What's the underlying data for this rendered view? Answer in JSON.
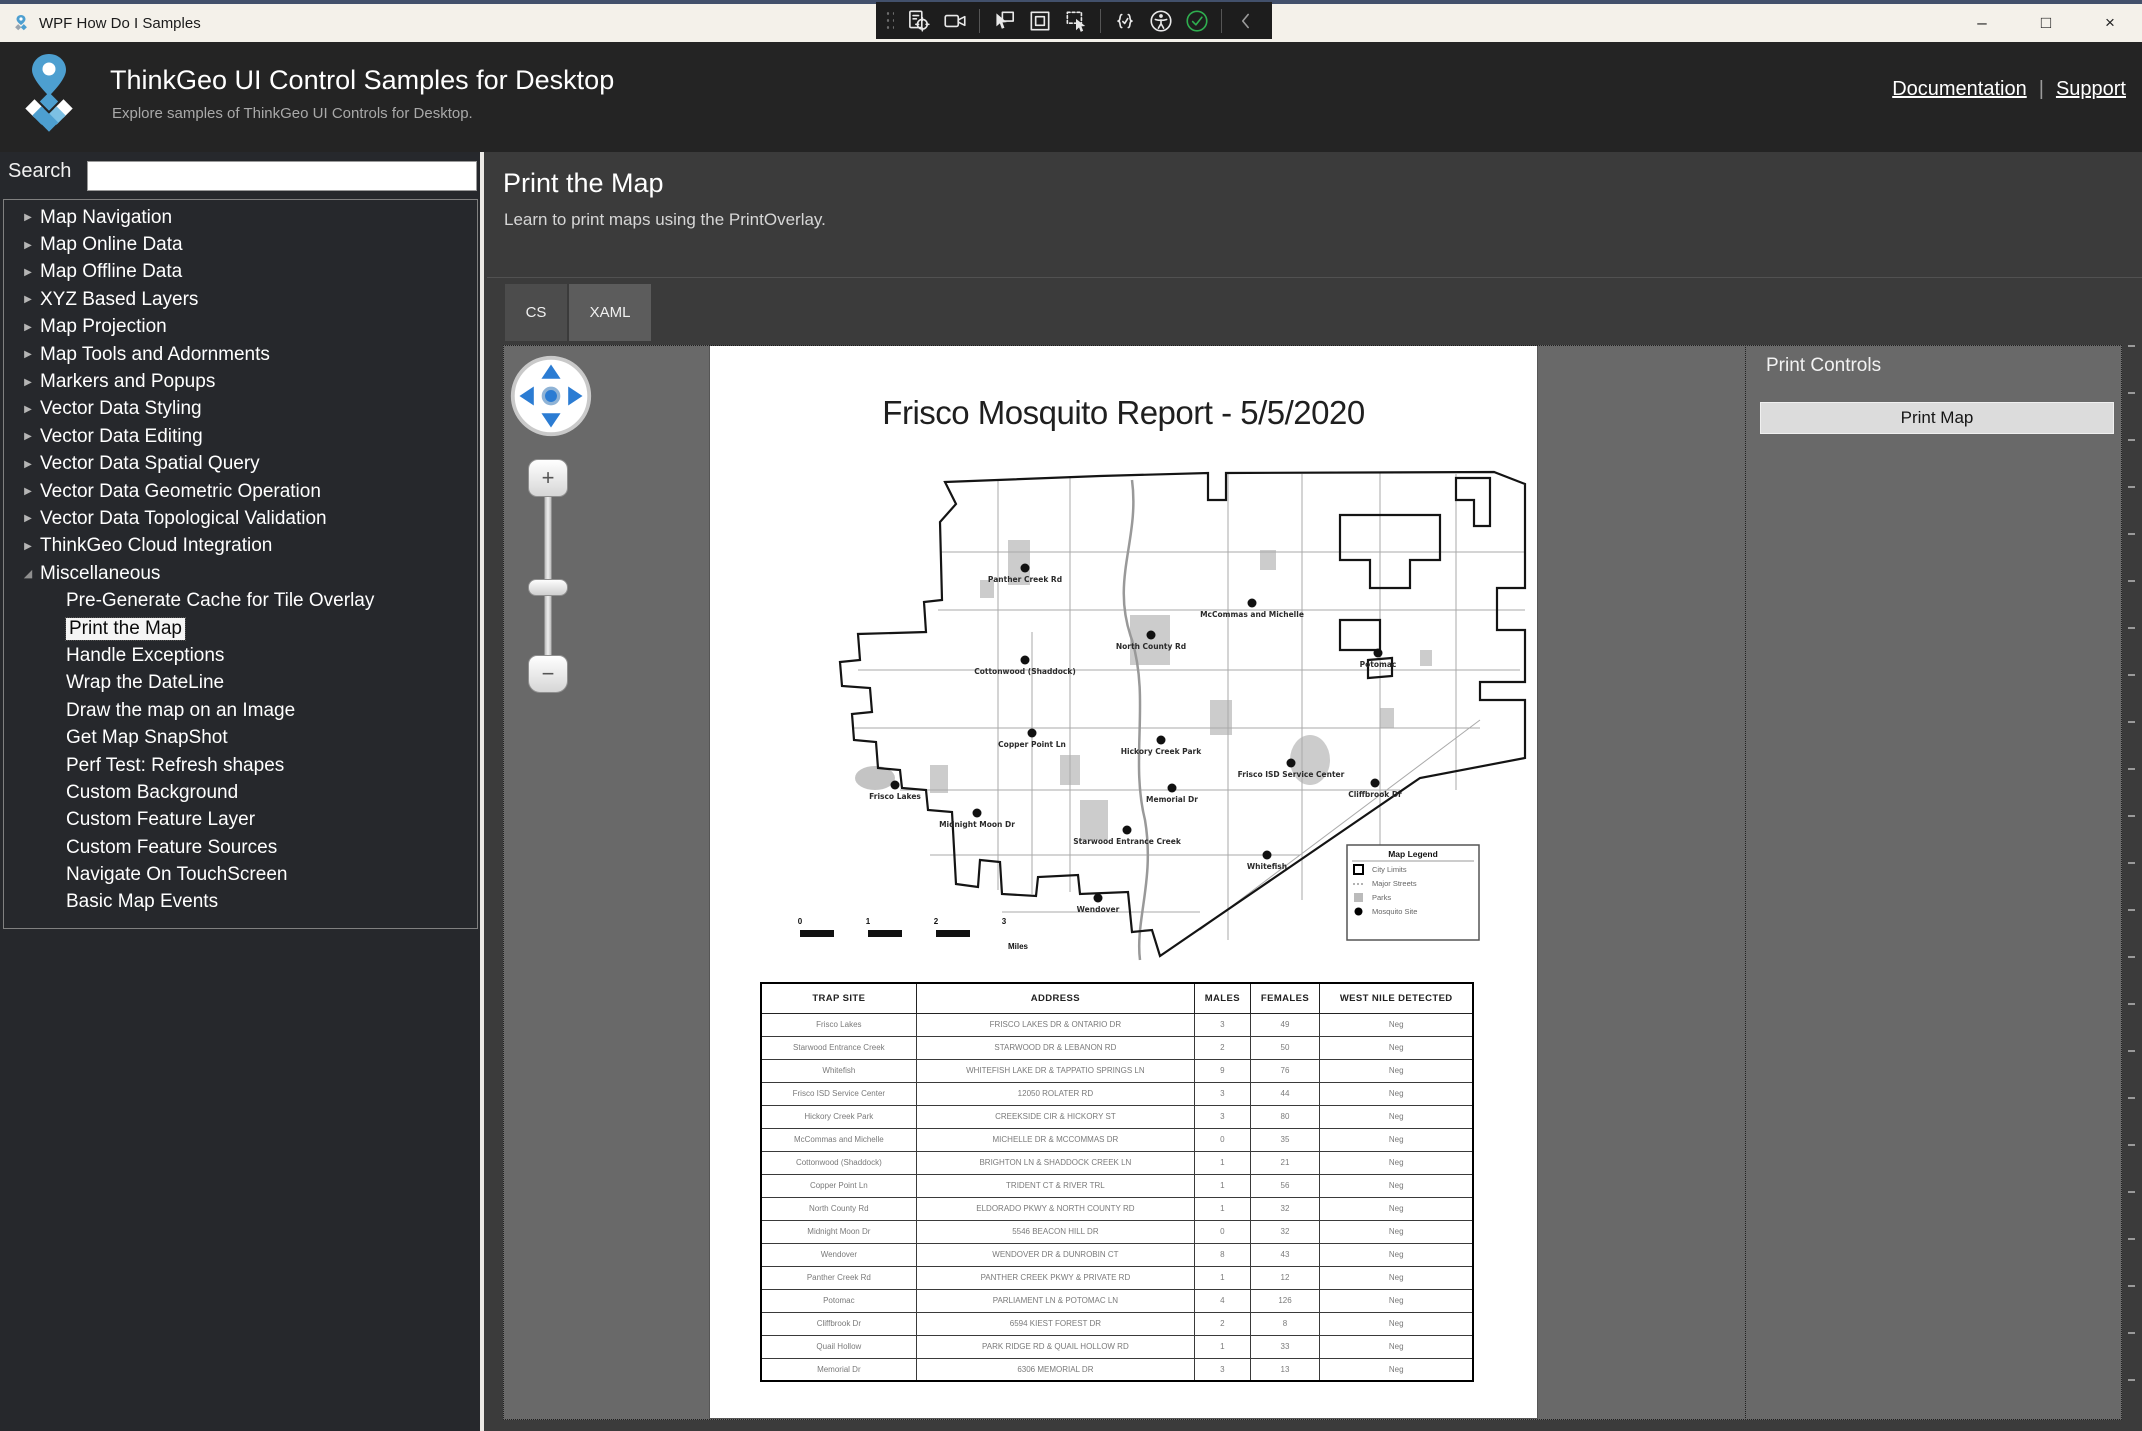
{
  "window": {
    "title": "WPF How Do I Samples",
    "controls": [
      {
        "name": "minimize-button",
        "glyph": "–"
      },
      {
        "name": "maximize-button",
        "glyph": "□"
      },
      {
        "name": "close-button",
        "glyph": "×"
      }
    ]
  },
  "overlay_toolbar": {
    "icons": [
      {
        "name": "record-target-icon"
      },
      {
        "name": "camera-icon"
      },
      {
        "name": "cursor-select-icon"
      },
      {
        "name": "window-frame-icon"
      },
      {
        "name": "region-capture-icon"
      },
      {
        "name": "code-check-icon"
      },
      {
        "name": "accessibility-icon"
      },
      {
        "name": "check-circle-icon"
      },
      {
        "name": "chevron-left-icon"
      }
    ]
  },
  "header": {
    "title": "ThinkGeo UI Control Samples for Desktop",
    "subtitle": "Explore samples of ThinkGeo UI Controls for Desktop.",
    "links": [
      "Documentation",
      "Support"
    ],
    "link_separator": "|"
  },
  "sidebar": {
    "search_label": "Search",
    "search_value": "",
    "tree": [
      {
        "label": "Map Navigation",
        "state": "collapsed"
      },
      {
        "label": "Map Online Data",
        "state": "collapsed"
      },
      {
        "label": "Map Offline Data",
        "state": "collapsed"
      },
      {
        "label": "XYZ Based Layers",
        "state": "collapsed"
      },
      {
        "label": "Map Projection",
        "state": "collapsed"
      },
      {
        "label": "Map Tools and Adornments",
        "state": "collapsed"
      },
      {
        "label": "Markers and Popups",
        "state": "collapsed"
      },
      {
        "label": "Vector Data Styling",
        "state": "collapsed"
      },
      {
        "label": "Vector Data Editing",
        "state": "collapsed"
      },
      {
        "label": "Vector Data Spatial Query",
        "state": "collapsed"
      },
      {
        "label": "Vector Data Geometric Operation",
        "state": "collapsed"
      },
      {
        "label": "Vector Data Topological Validation",
        "state": "collapsed"
      },
      {
        "label": "ThinkGeo Cloud Integration",
        "state": "collapsed"
      },
      {
        "label": "Miscellaneous",
        "state": "expanded"
      },
      {
        "label": "Pre-Generate Cache for Tile Overlay",
        "state": "child"
      },
      {
        "label": "Print the Map",
        "state": "child",
        "selected": true
      },
      {
        "label": "Handle Exceptions",
        "state": "child"
      },
      {
        "label": "Wrap the DateLine",
        "state": "child"
      },
      {
        "label": "Draw the map on an Image",
        "state": "child"
      },
      {
        "label": "Get Map SnapShot",
        "state": "child"
      },
      {
        "label": "Perf Test: Refresh shapes",
        "state": "child"
      },
      {
        "label": "Custom Background",
        "state": "child"
      },
      {
        "label": "Custom Feature Layer",
        "state": "child"
      },
      {
        "label": "Custom Feature Sources",
        "state": "child"
      },
      {
        "label": "Navigate On TouchScreen",
        "state": "child"
      },
      {
        "label": "Basic Map Events",
        "state": "child"
      }
    ]
  },
  "main": {
    "title": "Print the Map",
    "subtitle": "Learn to print maps using the PrintOverlay.",
    "tabs": [
      {
        "label": "CS",
        "active": false
      },
      {
        "label": "XAML",
        "active": true
      }
    ]
  },
  "print_panel": {
    "title": "Print Controls",
    "button": "Print Map"
  },
  "map_page": {
    "title": "Frisco Mosquito Report - 5/5/2020",
    "legend": {
      "title": "Map Legend",
      "items": [
        {
          "label": "City Limits",
          "symbol": "square-outline"
        },
        {
          "label": "Major Streets",
          "symbol": "dashed-line"
        },
        {
          "label": "Parks",
          "symbol": "filled-square"
        },
        {
          "label": "Mosquito Site",
          "symbol": "dot"
        }
      ]
    },
    "scalebar": {
      "labels": [
        "0",
        "1",
        "2",
        "3"
      ],
      "unit": "Miles"
    },
    "sites": [
      {
        "name": "Panther Creek Rd",
        "x": 245,
        "y": 108
      },
      {
        "name": "McCommas and Michelle",
        "x": 472,
        "y": 143
      },
      {
        "name": "North County Rd",
        "x": 371,
        "y": 175
      },
      {
        "name": "Cottonwood (Shaddock)",
        "x": 245,
        "y": 200
      },
      {
        "name": "Potomac",
        "x": 598,
        "y": 193
      },
      {
        "name": "Copper Point Ln",
        "x": 252,
        "y": 273
      },
      {
        "name": "Hickory Creek Park",
        "x": 381,
        "y": 280
      },
      {
        "name": "Frisco ISD Service Center",
        "x": 511,
        "y": 303
      },
      {
        "name": "Cliffbrook Dr",
        "x": 595,
        "y": 323
      },
      {
        "name": "Memorial Dr",
        "x": 392,
        "y": 328
      },
      {
        "name": "Frisco Lakes",
        "x": 115,
        "y": 325
      },
      {
        "name": "Midnight Moon Dr",
        "x": 197,
        "y": 353
      },
      {
        "name": "Starwood Entrance Creek",
        "x": 347,
        "y": 370
      },
      {
        "name": "Whitefish",
        "x": 487,
        "y": 395
      },
      {
        "name": "Wendover",
        "x": 318,
        "y": 438
      }
    ],
    "table": {
      "headers": [
        "TRAP SITE",
        "ADDRESS",
        "MALES",
        "FEMALES",
        "WEST NILE DETECTED"
      ],
      "rows": [
        [
          "Frisco Lakes",
          "FRISCO LAKES DR & ONTARIO DR",
          "3",
          "49",
          "Neg"
        ],
        [
          "Starwood Entrance Creek",
          "STARWOOD DR & LEBANON RD",
          "2",
          "50",
          "Neg"
        ],
        [
          "Whitefish",
          "WHITEFISH LAKE DR & TAPPATIO SPRINGS LN",
          "9",
          "76",
          "Neg"
        ],
        [
          "Frisco ISD Service Center",
          "12050 ROLATER RD",
          "3",
          "44",
          "Neg"
        ],
        [
          "Hickory Creek Park",
          "CREEKSIDE CIR & HICKORY ST",
          "3",
          "80",
          "Neg"
        ],
        [
          "McCommas and Michelle",
          "MICHELLE DR & MCCOMMAS DR",
          "0",
          "35",
          "Neg"
        ],
        [
          "Cottonwood (Shaddock)",
          "BRIGHTON LN & SHADDOCK CREEK LN",
          "1",
          "21",
          "Neg"
        ],
        [
          "Copper Point Ln",
          "TRIDENT CT & RIVER TRL",
          "1",
          "56",
          "Neg"
        ],
        [
          "North County Rd",
          "ELDORADO PKWY & NORTH COUNTY RD",
          "1",
          "32",
          "Neg"
        ],
        [
          "Midnight Moon Dr",
          "5546 BEACON HILL DR",
          "0",
          "32",
          "Neg"
        ],
        [
          "Wendover",
          "WENDOVER DR & DUNROBIN CT",
          "8",
          "43",
          "Neg"
        ],
        [
          "Panther Creek Rd",
          "PANTHER CREEK PKWY & PRIVATE RD",
          "1",
          "12",
          "Neg"
        ],
        [
          "Potomac",
          "PARLIAMENT LN & POTOMAC LN",
          "4",
          "126",
          "Neg"
        ],
        [
          "Cliffbrook Dr",
          "6594 KIEST FOREST DR",
          "2",
          "8",
          "Neg"
        ],
        [
          "Quail Hollow",
          "PARK RIDGE RD & QUAIL HOLLOW RD",
          "1",
          "33",
          "Neg"
        ],
        [
          "Memorial Dr",
          "6306 MEMORIAL DR",
          "3",
          "13",
          "Neg"
        ]
      ]
    }
  },
  "colors": {
    "accent_blue": "#2b7cd3",
    "link_blue": "#56a8dc",
    "titlebar_bg": "#f4f1ea",
    "header_bg": "#242424",
    "sidebar_bg": "#26282c",
    "main_bg": "#3b3b3b",
    "viewport_bg": "#696969",
    "check_green": "#2fae4f"
  }
}
